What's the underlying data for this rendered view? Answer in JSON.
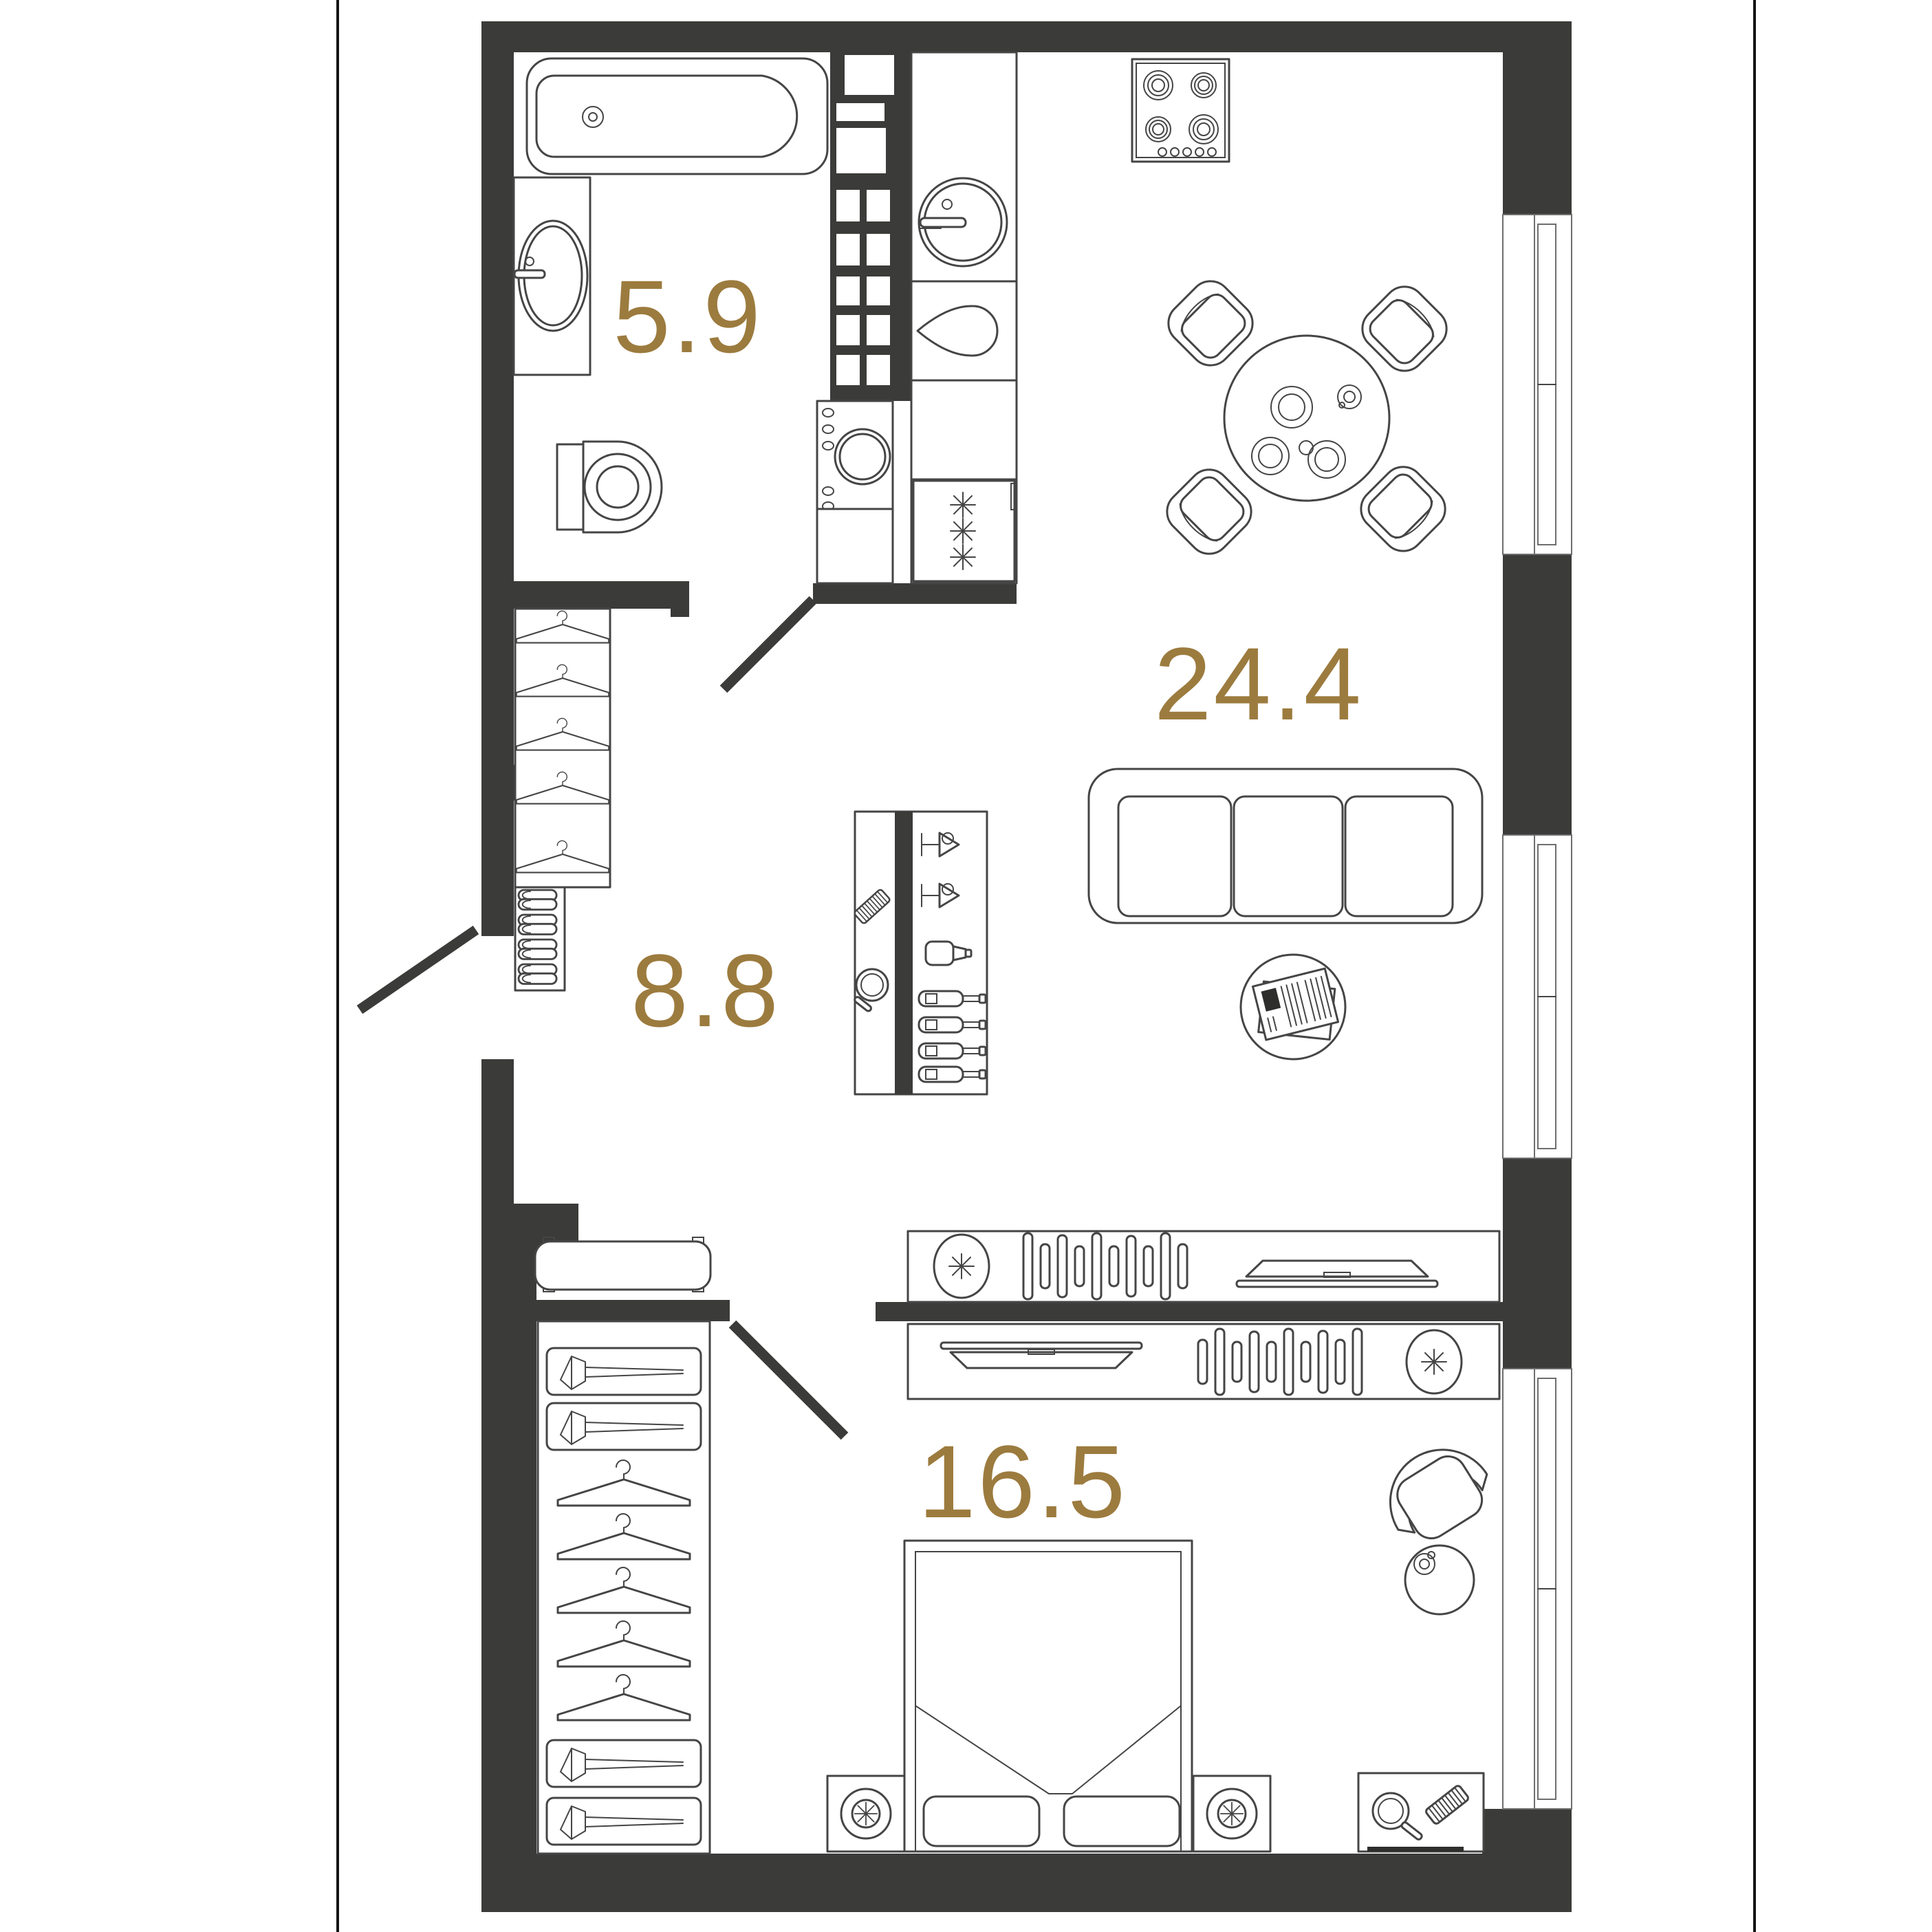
{
  "document": {
    "kind": "apartment-floor-plan",
    "units": "m2"
  },
  "colors": {
    "wall": "#3b3b39",
    "line": "#454545",
    "label": "#9c7b3e",
    "background": "#ffffff"
  },
  "rooms": [
    {
      "name": "bathroom",
      "area_label": "5.9"
    },
    {
      "name": "kitchen-living-room",
      "area_label": "24.4"
    },
    {
      "name": "hallway",
      "area_label": "8.8"
    },
    {
      "name": "bedroom",
      "area_label": "16.5"
    }
  ],
  "fixtures": {
    "bathroom": [
      "bathtub",
      "washbasin",
      "toilet",
      "washing-machine",
      "ventilation-shaft"
    ],
    "kitchen-living-room": [
      "kitchen-sink",
      "teardrop-board",
      "fridge",
      "cooktop",
      "dining-table",
      "dining-chairs-x4",
      "plates",
      "cup",
      "sofa",
      "coffee-table",
      "newspaper",
      "tv-stand",
      "speaker",
      "records",
      "tv"
    ],
    "hallway": [
      "coat-closet",
      "hangers-x5",
      "slipper-shelf",
      "slippers-x4",
      "bar-cabinet",
      "comb",
      "hand-mirror",
      "martini-glasses-x2",
      "shaker",
      "bottles-x4",
      "bench"
    ],
    "bedroom": [
      "wardrobe",
      "storage-boxes-x4",
      "hangers-x5",
      "double-bed",
      "pillows-x2",
      "nightstands-x2",
      "lamps-x2",
      "tv-stand",
      "tv",
      "records",
      "speaker",
      "armchair",
      "side-table",
      "cup",
      "vanity-desk",
      "hand-mirror",
      "comb",
      "pen"
    ],
    "windows": 3,
    "door-swings": 3
  }
}
